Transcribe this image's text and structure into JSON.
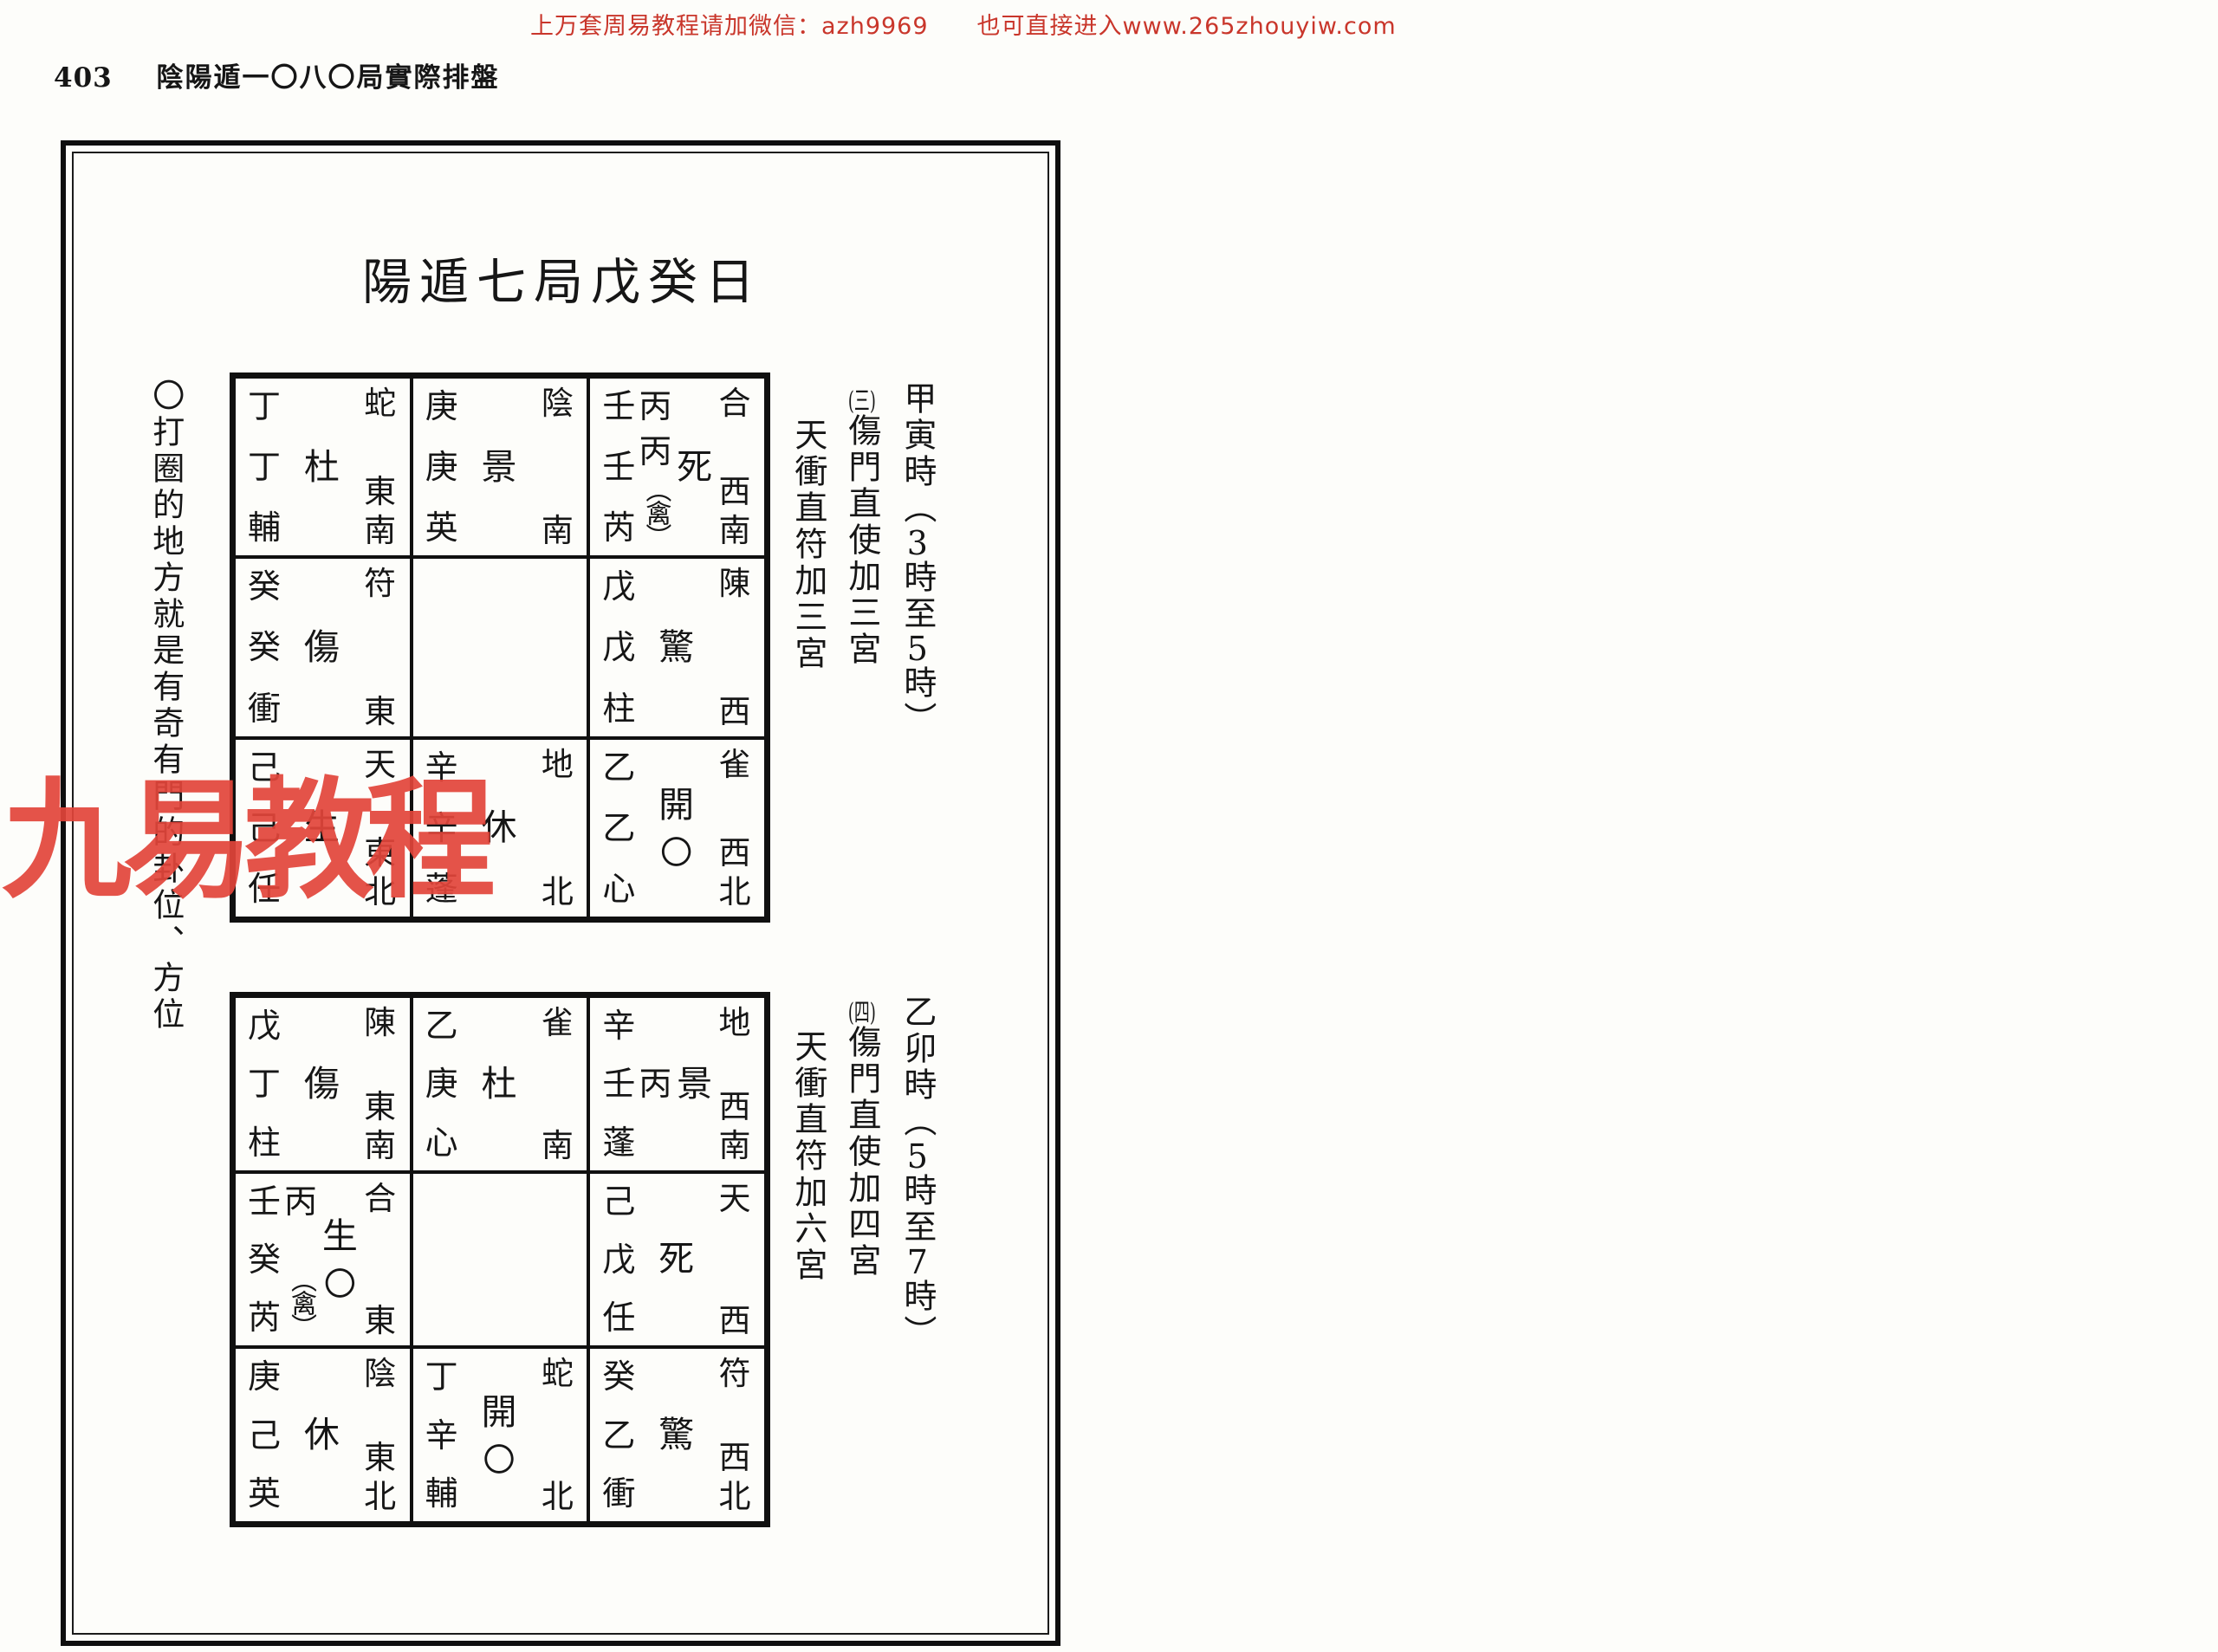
{
  "top_banner": "上万套周易教程请加微信：azh9969　　也可直接进入www.265zhouyiw.com",
  "page": {
    "number": "403",
    "header_title": "陰陽遁一〇八〇局實際排盤"
  },
  "chart_title": "陽遁七局戊癸日",
  "side_note": "〇打圈的地方就是有奇有門的卦位、方位",
  "watermark": "九易教程",
  "ink_color": "#161616",
  "banner_color": "#c9362b",
  "watermark_color": "#e2453a",
  "boards": [
    {
      "ann": {
        "time_pre": "甲寅時",
        "open": "（",
        "d1": "3",
        "mid": "時至",
        "d2": "5",
        "tail": "時）",
        "seq": "(三)",
        "line2": "傷門直使加三宮",
        "line3": "天衝直符加三宮"
      },
      "cells": [
        {
          "cols": [
            [
              "丁",
              "丁",
              "輔"
            ]
          ],
          "gate": "杜",
          "circle": "",
          "god": "蛇",
          "dir": "東南"
        },
        {
          "cols": [
            [
              "庚",
              "庚",
              "英"
            ]
          ],
          "gate": "景",
          "circle": "",
          "god": "陰",
          "dir": "南"
        },
        {
          "cols": [
            [
              "壬",
              "壬",
              "芮"
            ],
            [
              "丙",
              "丙",
              "（禽）"
            ]
          ],
          "gate": "死",
          "circle": "",
          "god": "合",
          "dir": "西南"
        },
        {
          "cols": [
            [
              "癸",
              "癸",
              "衝"
            ]
          ],
          "gate": "傷",
          "circle": "",
          "god": "符",
          "dir": "東"
        },
        {
          "cols": [],
          "gate": "",
          "circle": "",
          "god": "",
          "dir": ""
        },
        {
          "cols": [
            [
              "戊",
              "戊",
              "柱"
            ]
          ],
          "gate": "驚",
          "circle": "",
          "god": "陳",
          "dir": "西"
        },
        {
          "cols": [
            [
              "己",
              "己",
              "任"
            ]
          ],
          "gate": "生",
          "circle": "",
          "god": "天",
          "dir": "東北"
        },
        {
          "cols": [
            [
              "辛",
              "辛",
              "蓬"
            ]
          ],
          "gate": "休",
          "circle": "",
          "god": "地",
          "dir": "北"
        },
        {
          "cols": [
            [
              "乙",
              "乙",
              "心"
            ]
          ],
          "gate": "開",
          "circle": "〇",
          "god": "雀",
          "dir": "西北"
        }
      ]
    },
    {
      "ann": {
        "time_pre": "乙卯時",
        "open": "（",
        "d1": "5",
        "mid": "時至",
        "d2": "7",
        "tail": "時）",
        "seq": "(四)",
        "line2": "傷門直使加四宮",
        "line3": "天衝直符加六宮"
      },
      "cells": [
        {
          "cols": [
            [
              "戊",
              "丁",
              "柱"
            ]
          ],
          "gate": "傷",
          "circle": "",
          "god": "陳",
          "dir": "東南"
        },
        {
          "cols": [
            [
              "乙",
              "庚",
              "心"
            ]
          ],
          "gate": "杜",
          "circle": "",
          "god": "雀",
          "dir": "南"
        },
        {
          "cols": [
            [
              "辛",
              "壬",
              "蓬"
            ],
            [
              "",
              "丙",
              ""
            ]
          ],
          "gate": "景",
          "circle": "",
          "god": "地",
          "dir": "西南"
        },
        {
          "cols": [
            [
              "壬",
              "癸",
              "芮"
            ],
            [
              "丙",
              "（禽）"
            ]
          ],
          "gate": "生",
          "circle": "〇",
          "god": "合",
          "dir": "東"
        },
        {
          "cols": [],
          "gate": "",
          "circle": "",
          "god": "",
          "dir": ""
        },
        {
          "cols": [
            [
              "己",
              "戊",
              "任"
            ]
          ],
          "gate": "死",
          "circle": "",
          "god": "天",
          "dir": "西"
        },
        {
          "cols": [
            [
              "庚",
              "己",
              "英"
            ]
          ],
          "gate": "休",
          "circle": "",
          "god": "陰",
          "dir": "東北"
        },
        {
          "cols": [
            [
              "丁",
              "辛",
              "輔"
            ]
          ],
          "gate": "開",
          "circle": "〇",
          "god": "蛇",
          "dir": "北"
        },
        {
          "cols": [
            [
              "癸",
              "乙",
              "衝"
            ]
          ],
          "gate": "驚",
          "circle": "",
          "god": "符",
          "dir": "西北"
        }
      ]
    }
  ]
}
